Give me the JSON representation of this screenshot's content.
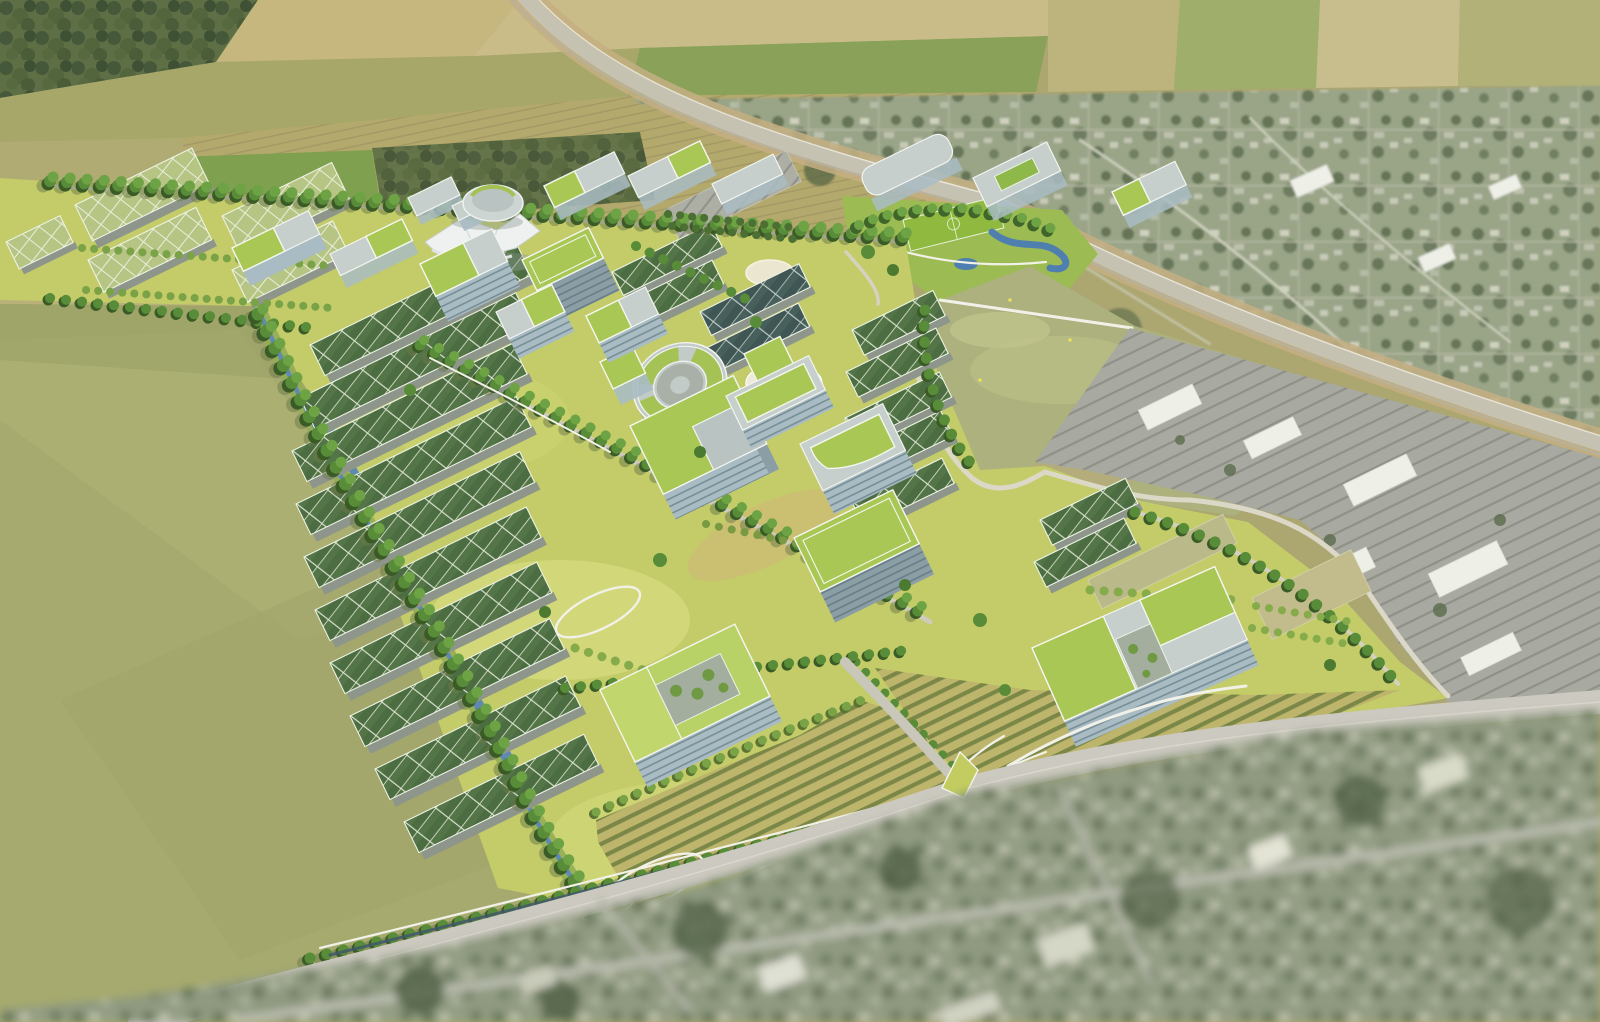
{
  "scene": {
    "type": "aerial-architectural-rendering",
    "description": "Bird's-eye rendering of a sustainable research campus master plan: rows of long solar green-roofed lab buildings and glass office cubes with planted roofs arranged along a diagonal spine with tree allees, a central white tent pavilion, drum hall and circular courtyard building, orchards and a creek greenway at the edges. Surrounding context: patchwork farmland above, a diagonal highway and rail corridor with an existing suburb to the right, an open meadow and big-box commercial strip, a large fallow field lower left, and a blurred existing neighborhood in the foreground.",
    "visible_text": [],
    "regions": [
      {
        "name": "farmland-patchwork",
        "position": "top-left and top-center"
      },
      {
        "name": "woodland-blocks",
        "position": "top-left corner and mid-top"
      },
      {
        "name": "highway-rail-corridor",
        "position": "diagonal, upper right"
      },
      {
        "name": "existing-suburb",
        "position": "right of highway"
      },
      {
        "name": "neighborhood-park",
        "position": "upper right of campus with soccer field and ponds"
      },
      {
        "name": "open-meadow",
        "position": "right-center"
      },
      {
        "name": "commercial-strip",
        "position": "right, parking lots and white big-box stores"
      },
      {
        "name": "campus-core",
        "position": "center diagonal band"
      },
      {
        "name": "solar-roof-lab-rows",
        "position": "center-left cluster and north-east clusters"
      },
      {
        "name": "glass-cube-offices",
        "position": "campus spine with green roofs"
      },
      {
        "name": "tent-pavilion-and-drum-hall",
        "position": "upper campus"
      },
      {
        "name": "ring-courtyard-building",
        "position": "campus center"
      },
      {
        "name": "greenhouse-blocks",
        "position": "campus north-west"
      },
      {
        "name": "orchard-parcels",
        "position": "campus south edge"
      },
      {
        "name": "creek-greenway",
        "position": "campus west boundary"
      },
      {
        "name": "fallow-field",
        "position": "lower left"
      },
      {
        "name": "arterial-road",
        "position": "lower diagonal"
      },
      {
        "name": "blurred-foreground-suburb",
        "position": "bottom"
      }
    ]
  },
  "palette": {
    "base_ground": "#aca670",
    "field_tan": "#c6b77f",
    "field_olive": "#a7a76a",
    "field_green": "#7fa04e",
    "field_khaki": "#b4a96d",
    "field_pale": "#c9bd8a",
    "forest_dark": "#55663f",
    "suburb_base": "#9aa487",
    "meadow_base": "#acb17d",
    "park_green": "#9cbb53",
    "campus_lawn": "#c3cc69",
    "lawn_light": "#d9dc82",
    "big_field": "#a6aa6e",
    "orchard_base": "#bdb56c",
    "water_blue": "#5d89b2",
    "creek_bank": "#94ad55",
    "road_gray": "#ccc9c0",
    "highway_gray": "#c6c2b2",
    "rail_tan": "#c4af83",
    "path_white": "#f1f1e8",
    "tree_green": "#588c38",
    "tree_shadow": "#3a5a26",
    "orchard_tree": "#7aa246",
    "solar_roof": "#4c6c42",
    "solar_roof_dark": "#3f5654",
    "greenhouse_roof": "#b7c584",
    "roof_green": "#a9c754",
    "glass_wall": "#a9bcc3",
    "parking_gray": "#a8a9a0",
    "box_store_white": "#eef0e8",
    "foreground_base": "#8f9a80",
    "teardrop_green": "#c2cc60"
  }
}
